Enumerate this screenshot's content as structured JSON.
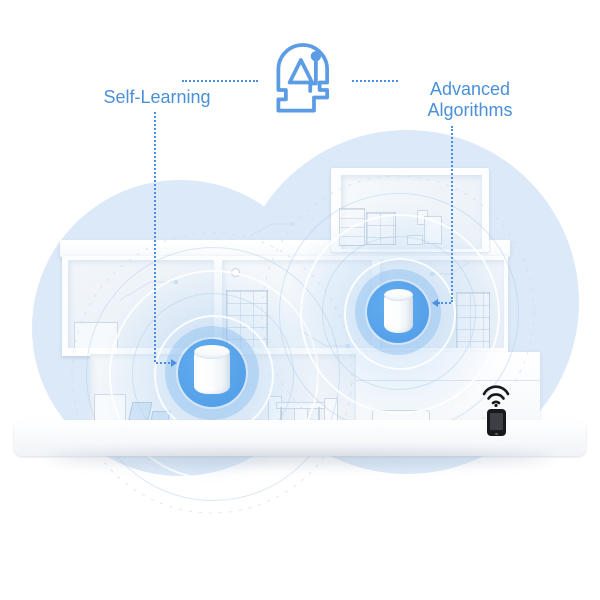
{
  "illustration": {
    "kind": "mesh-wifi-feature-callout",
    "callouts": {
      "left_label": "Self-Learning",
      "right_label": "Advanced Algorithms"
    },
    "icons": {
      "ai_head": "ai-head-icon",
      "wifi": "wifi-signal-icon",
      "smartphone": "smartphone-icon",
      "routers": [
        "mesh-router-left",
        "mesh-router-right"
      ]
    },
    "colors": {
      "label_text": "#4a90d9",
      "callout_line": "#4b8fe2",
      "ai_icon_stroke": "#5b9ce4",
      "router_disc_blue": "#55a3ea",
      "router_halo": "rgba(140,190,240,0.45)",
      "cloud_fill": "#dbe9f8",
      "phone_black": "#17191d",
      "house_white": "#ffffff"
    }
  }
}
